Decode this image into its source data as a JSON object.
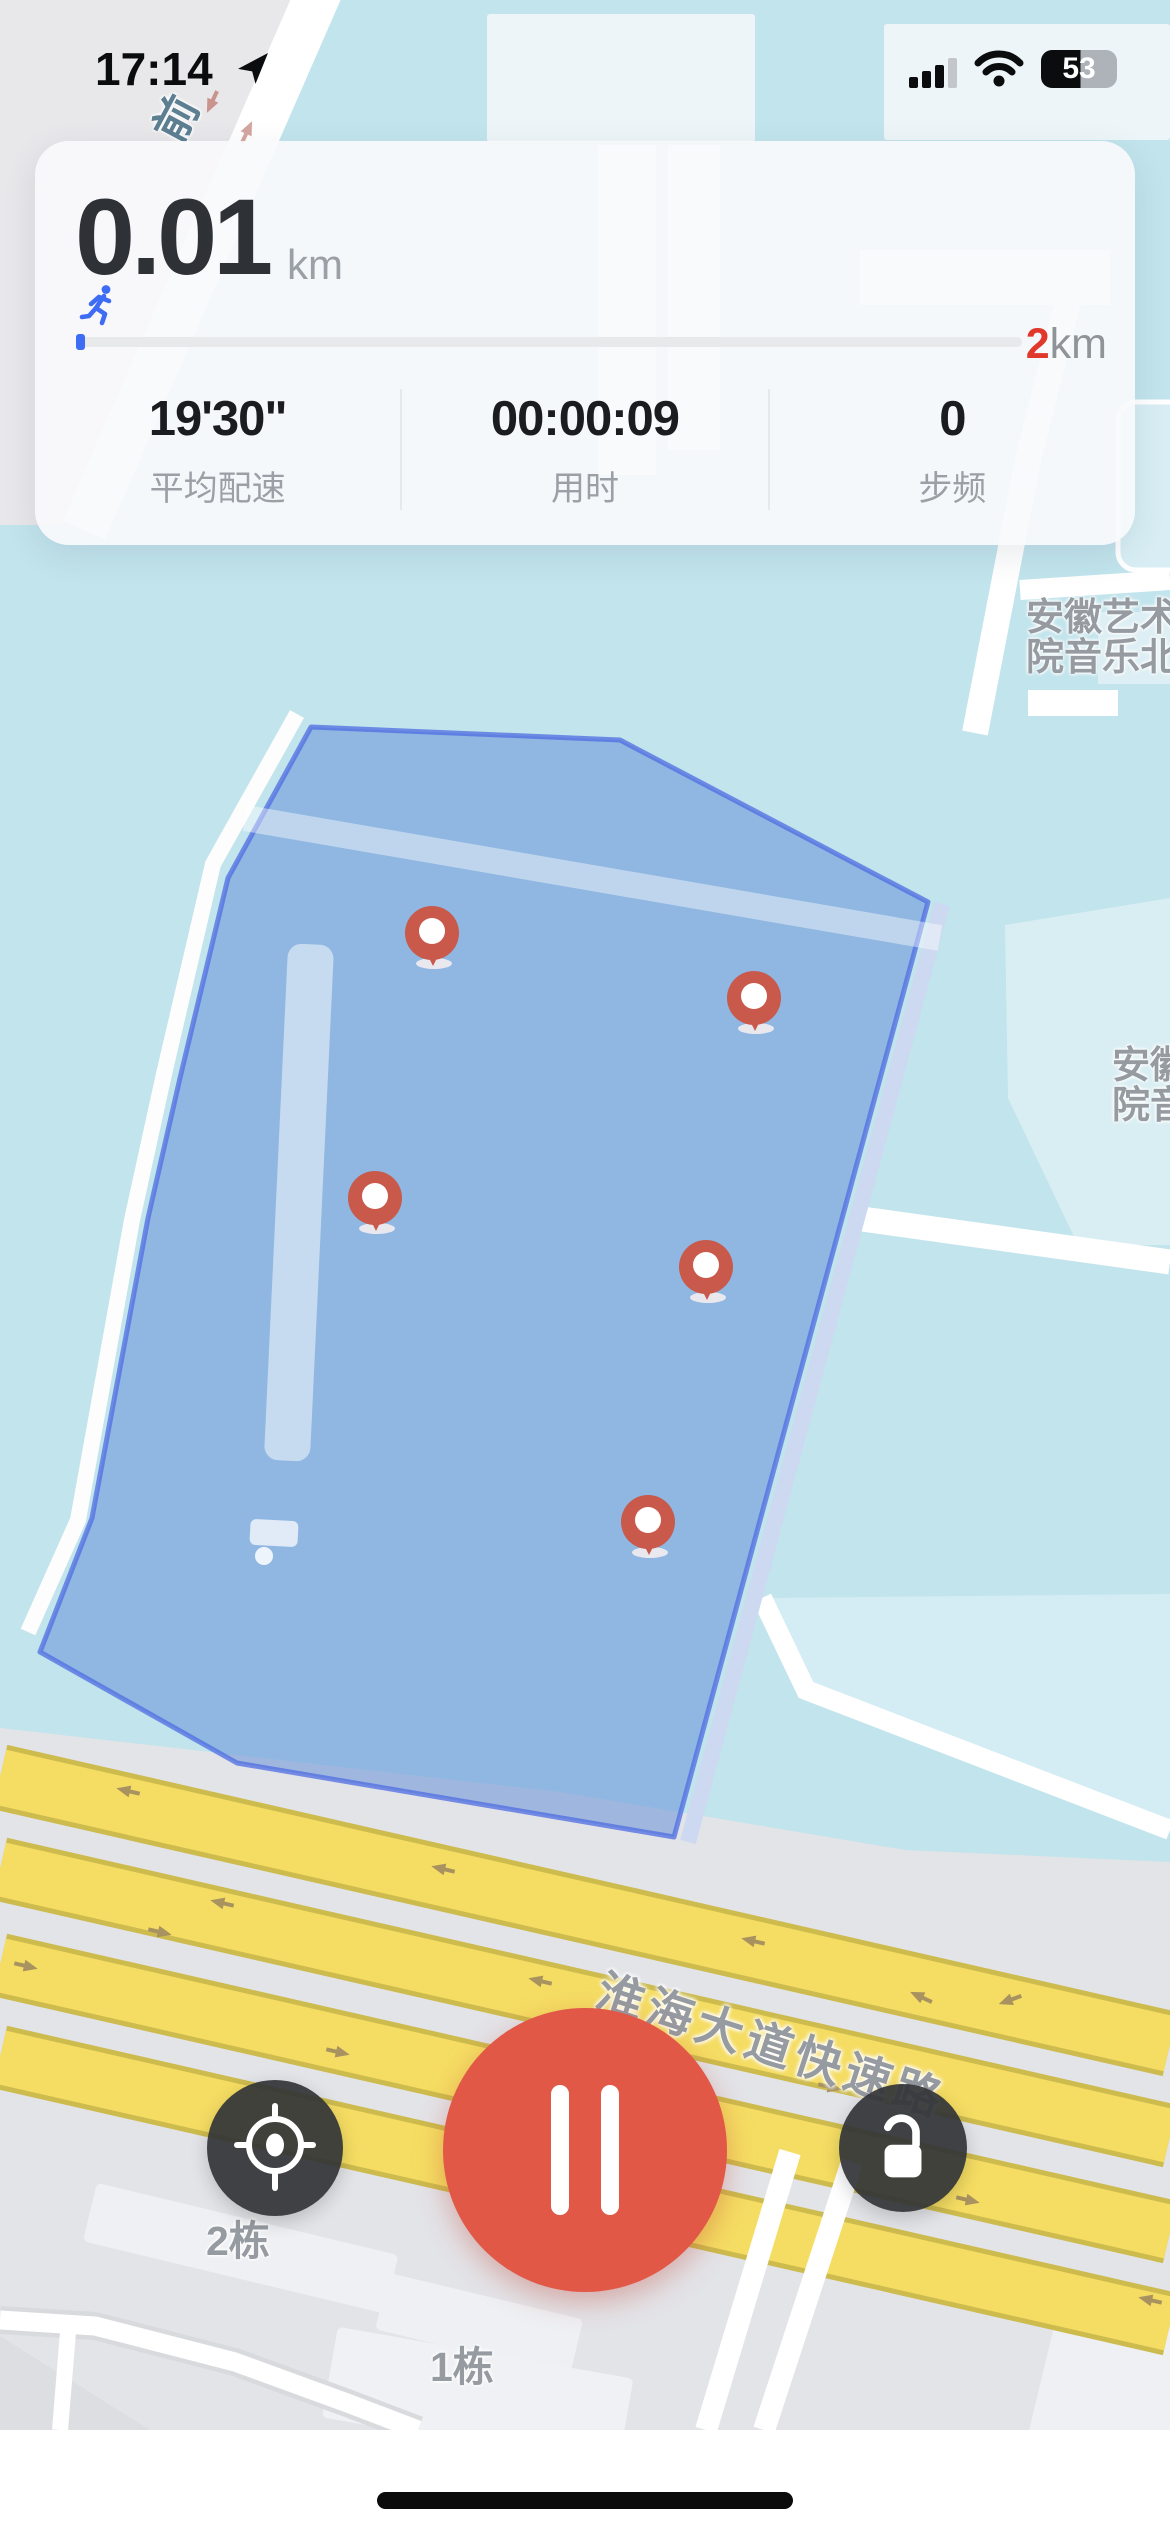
{
  "status_bar": {
    "time": "17:14",
    "battery_percent": "53"
  },
  "stats_card": {
    "distance": "0.01",
    "distance_unit": "km",
    "goal_value": "2",
    "goal_unit": "km",
    "metrics": [
      {
        "value": "19'30\"",
        "label": "平均配速"
      },
      {
        "value": "00:00:09",
        "label": "用时"
      },
      {
        "value": "0",
        "label": "步频"
      }
    ]
  },
  "map": {
    "labels": {
      "building_ne_line1": "安徽艺术",
      "building_ne_line2": "院音乐北",
      "building_e_line1": "安徽艺",
      "building_e_line2": "院音乐",
      "road_main": "淮海大道快速路",
      "road_nw": "前",
      "block_2": "2栋",
      "block_1": "1栋"
    }
  },
  "colors": {
    "accent_blue": "#3E6CF5",
    "goal_red": "#E0392B",
    "pause_red": "#E15847",
    "button_dark": "#333538",
    "polygon_fill": "#8DB6DF",
    "polygon_stroke": "#5E7BE2",
    "map_cyan": "#C2E4EC",
    "map_gray": "#E3E4E8",
    "road_yellow": "#F5DD63",
    "pin_red": "#C8594B"
  }
}
